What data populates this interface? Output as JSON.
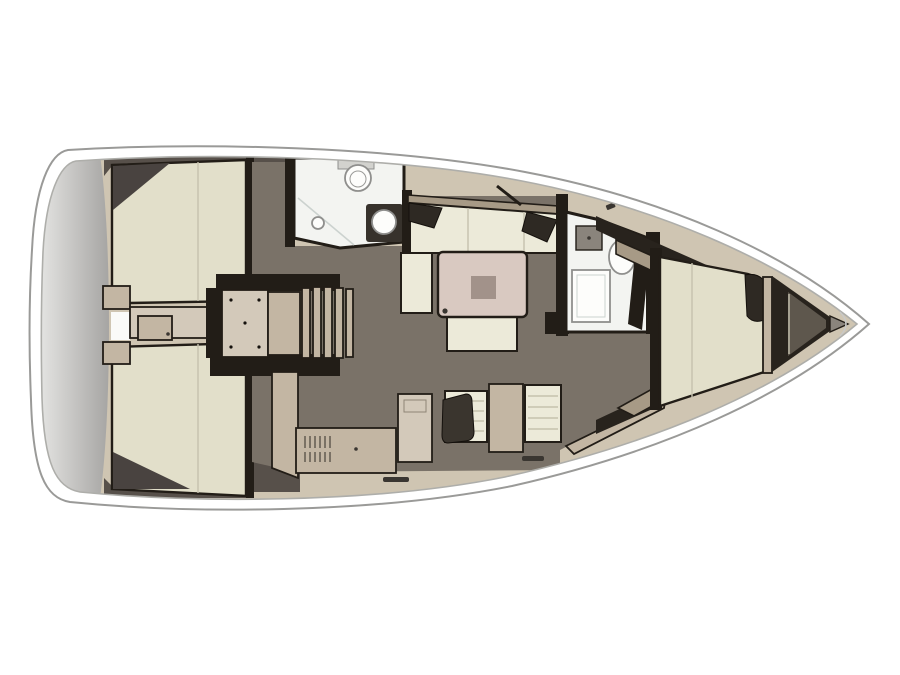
{
  "meta": {
    "type": "floor-plan-diagram",
    "subject": "sailing-yacht-interior-layout-top-view",
    "orientation": "bow-right-stern-left",
    "background": "#ffffff"
  },
  "regions": [
    {
      "name": "transom-swim-platform"
    },
    {
      "name": "aft-cabin-port-berth"
    },
    {
      "name": "aft-cabin-starboard-berth"
    },
    {
      "name": "companionway-steps"
    },
    {
      "name": "aft-head-toilet-sink-shower"
    },
    {
      "name": "salon-port-settee"
    },
    {
      "name": "salon-table"
    },
    {
      "name": "galley-stove-counters"
    },
    {
      "name": "forward-head-shower-sink"
    },
    {
      "name": "forward-cabin-v-berth"
    },
    {
      "name": "anchor-locker-bow"
    }
  ],
  "palette": {
    "pageBg": "#ffffff",
    "hullBand": "#ffffff",
    "hullStroke": "#9a9a98",
    "innerLine": "#aeaeaa",
    "deckBase": "#cfc5b2",
    "transomLight": "#e4e4e2",
    "transomDark": "#a6a5a3",
    "wallDark": "#221d17",
    "wallMid": "#57504a",
    "floor": "#7a7268",
    "berth": "#e2dfca",
    "cushion": "#ecead9",
    "wood": "#c3b6a3",
    "woodLight": "#d3c9ba",
    "woodDark": "#a79a86",
    "table": "#d9c9c1",
    "tableInset": "#a2928a",
    "headFloor": "#f3f4f1",
    "fixtureWhite": "#fdfdfb",
    "fixtureStroke": "#8f8f8d",
    "pillowDark": "#2e2923",
    "stove": "#3a352e",
    "metalGray": "#8a847c",
    "shadowWedge": "#494340",
    "seamLine": "#c5c1ae",
    "tickDark": "#3a3631",
    "glassLine": "#ccd2cf",
    "lockerDark": "#28231d",
    "lockerLight": "#5e574d",
    "slatLine": "#4a443c",
    "whiteGap": "#fafaf8"
  }
}
